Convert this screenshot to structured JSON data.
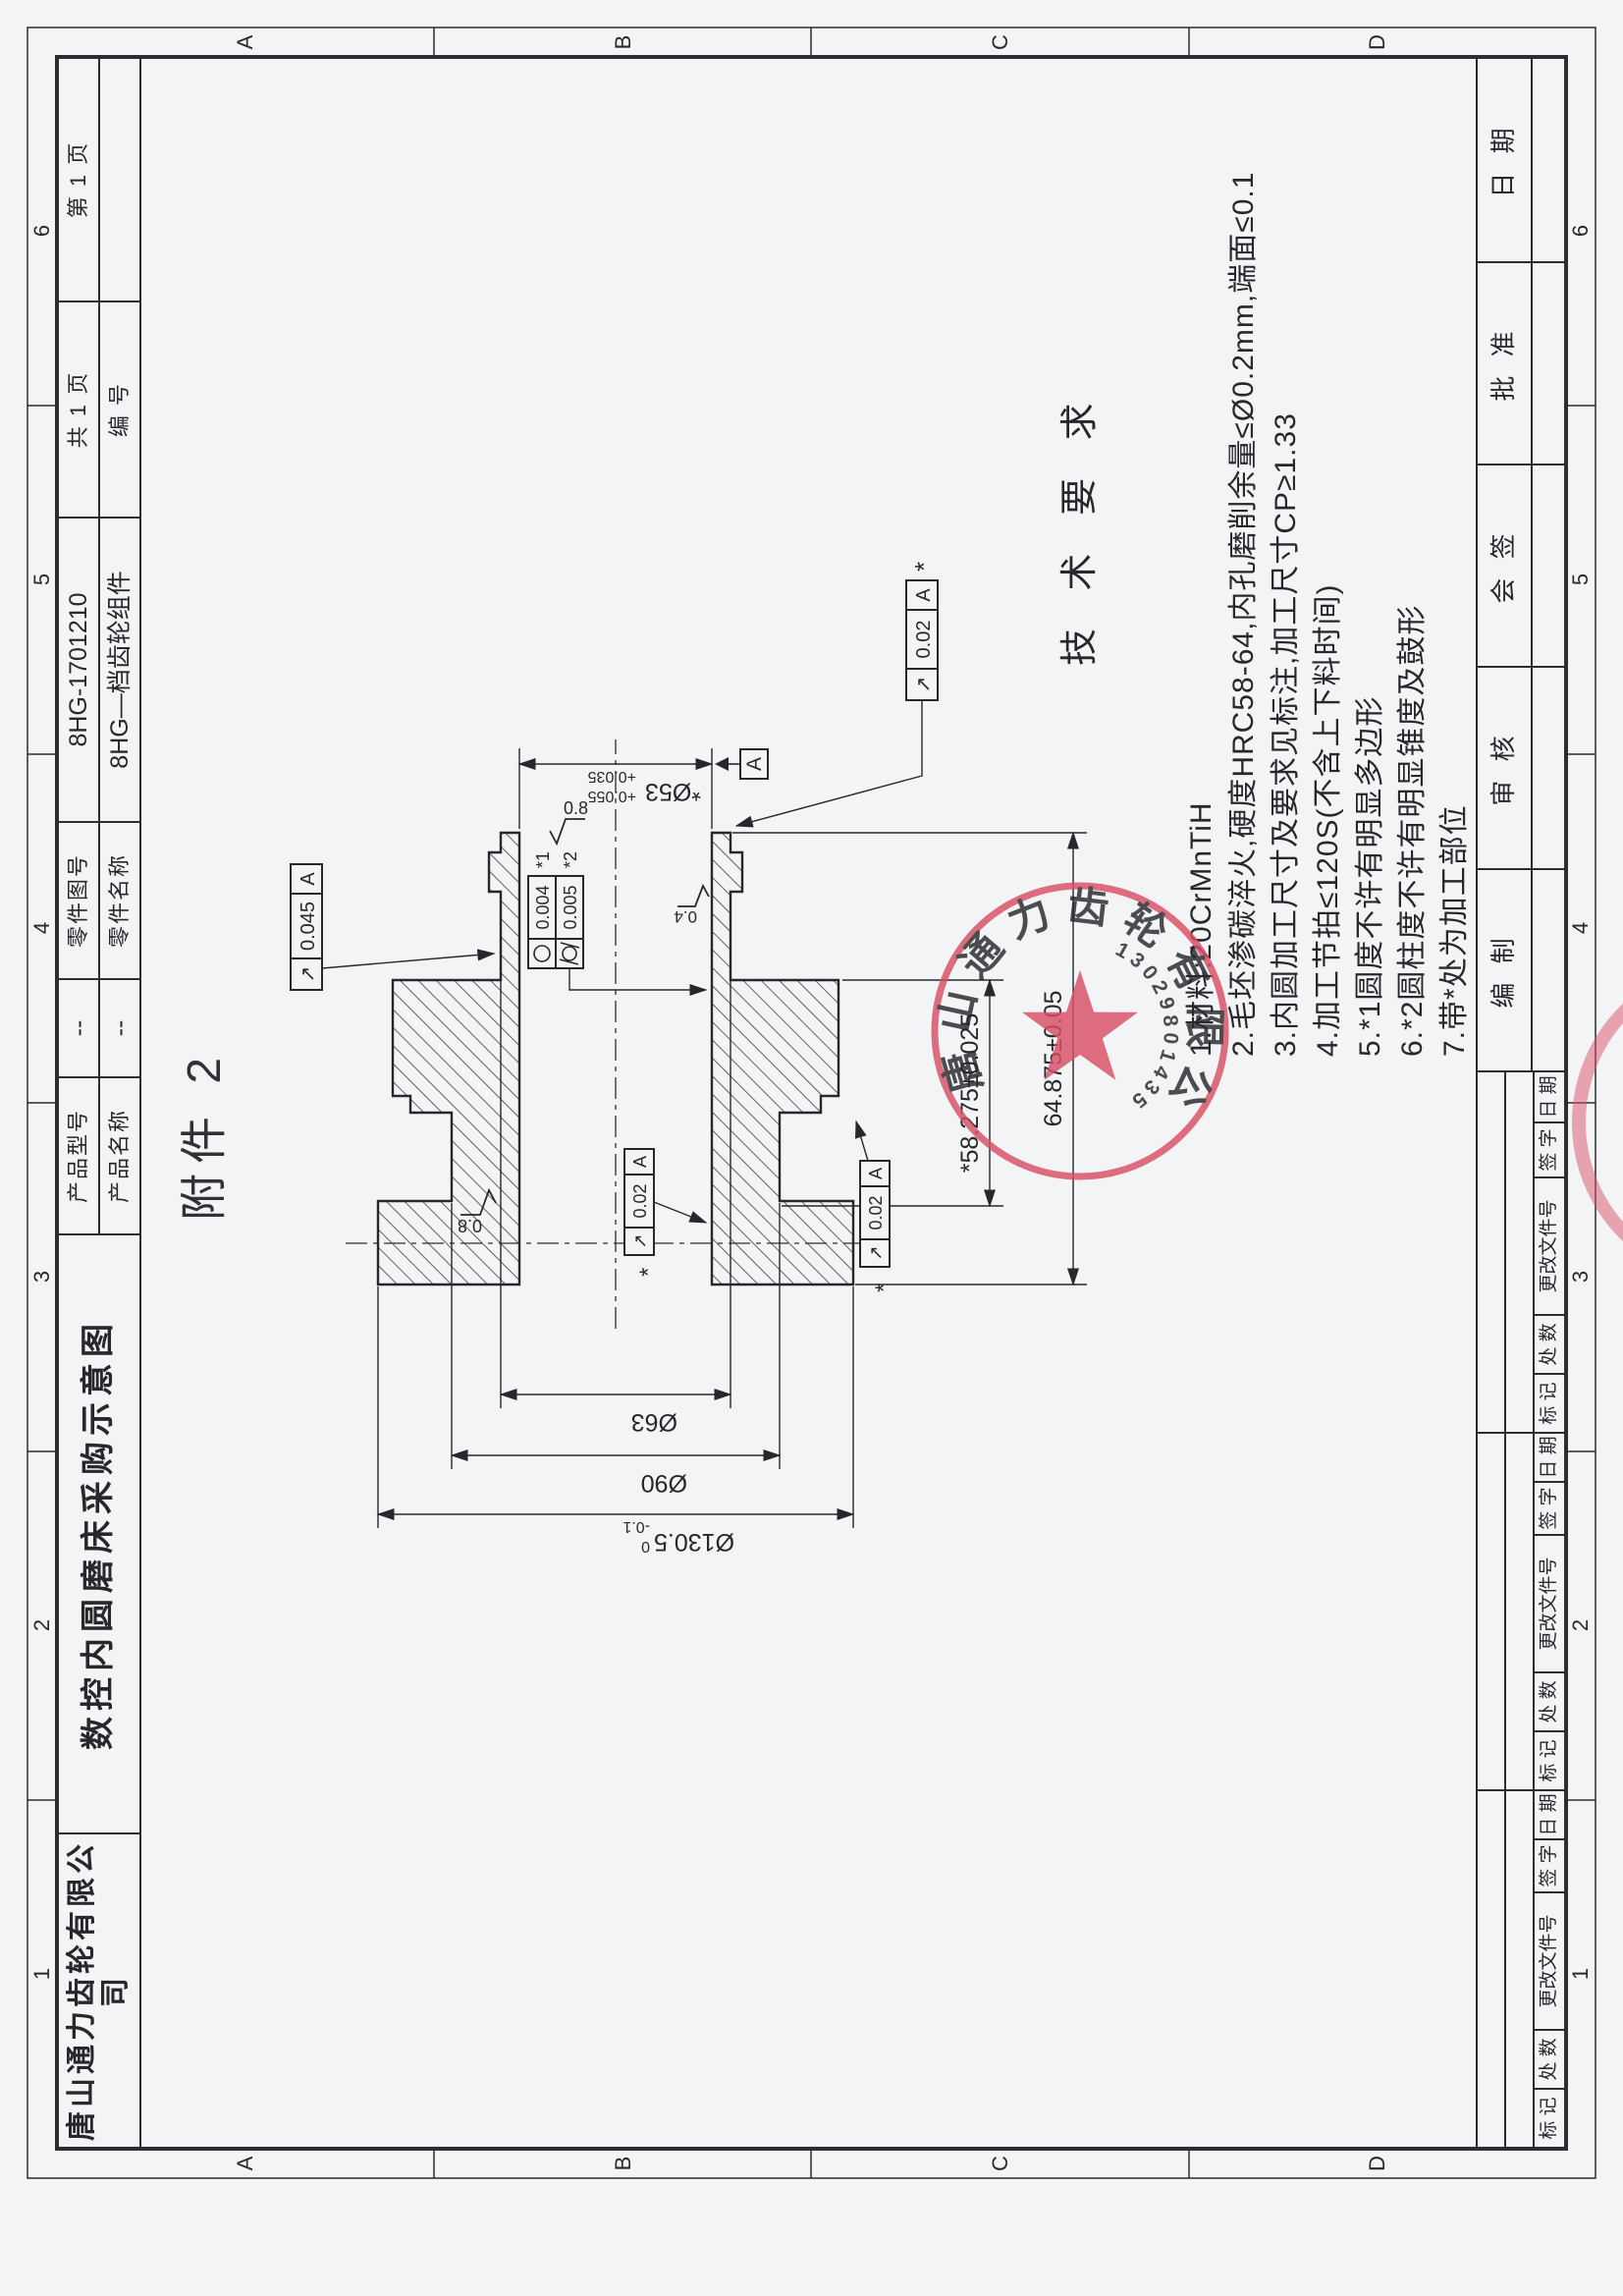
{
  "zones": {
    "letters": [
      "A",
      "B",
      "C",
      "D"
    ],
    "numbers": [
      "1",
      "2",
      "3",
      "4",
      "5",
      "6"
    ]
  },
  "header": {
    "company": "唐山通力齿轮有限公司",
    "drawing_title": "数控内圆磨床采购示意图",
    "product_model_label": "产品型号",
    "product_model": "--",
    "product_name_label": "产品名称",
    "product_name": "--",
    "part_no_label": "零件图号",
    "part_no": "8HG-1701210",
    "part_name_label": "零件名称",
    "part_name": "8HG—档齿轮组件",
    "total_pages": "共 1 页",
    "number_label": "编 号",
    "page": "第 1 页"
  },
  "attachment": "附件 2",
  "tech": {
    "title": "技 术 要 求",
    "items": [
      "1.材料:20CrMnTiH",
      "2.毛坯渗碳淬火,硬度HRC58-64,内孔磨削余量≤Ø0.2mm,端面≤0.1",
      "3.内圆加工尺寸及要求见标注,加工尺寸CP≥1.33",
      "4.加工节拍≤120S(不含上下料时间)",
      "5.*1圆度不许有明显多边形",
      "6.*2圆柱度不许有明显锥度及鼓形",
      "7.带*处为加工部位"
    ]
  },
  "dims": {
    "bore": "*Ø53",
    "bore_tol_up": "+0.055",
    "bore_tol_low": "+0.035",
    "d63": "Ø63",
    "d90": "Ø90",
    "d130": "Ø130.5",
    "d130_tol_up": "0",
    "d130_tol_low": "-0.1",
    "len_inner": "*58.275±0.025",
    "len_total": "64.875±0.05",
    "datum": "A"
  },
  "gdt": {
    "runout_sym": "↗",
    "f_left": {
      "val": "0.045",
      "datum": "A"
    },
    "f_right": {
      "val": "0.02",
      "datum": "A",
      "star": "*"
    },
    "f_bore": {
      "val": "0.02",
      "datum": "A",
      "star": "*"
    },
    "f_flange": {
      "val": "0.02",
      "datum": "A",
      "star": "*"
    },
    "circularity": {
      "val": "0.004",
      "tag": "*1"
    },
    "cylindricity": {
      "val": "0.005",
      "tag": "*2"
    },
    "rough_face_right": "0.8",
    "rough_face_left": "0.8",
    "rough_bore": "0.4"
  },
  "stamp": {
    "company_arc": "唐山通力齿轮有限公司",
    "code": "13029801435"
  },
  "bottom": {
    "rev_cols": [
      "标 记",
      "处 数",
      "更改文件号",
      "签 字",
      "日 期"
    ],
    "sign_cols": [
      "编 制",
      "审 核",
      "会 签",
      "批 准",
      "日 期"
    ]
  }
}
